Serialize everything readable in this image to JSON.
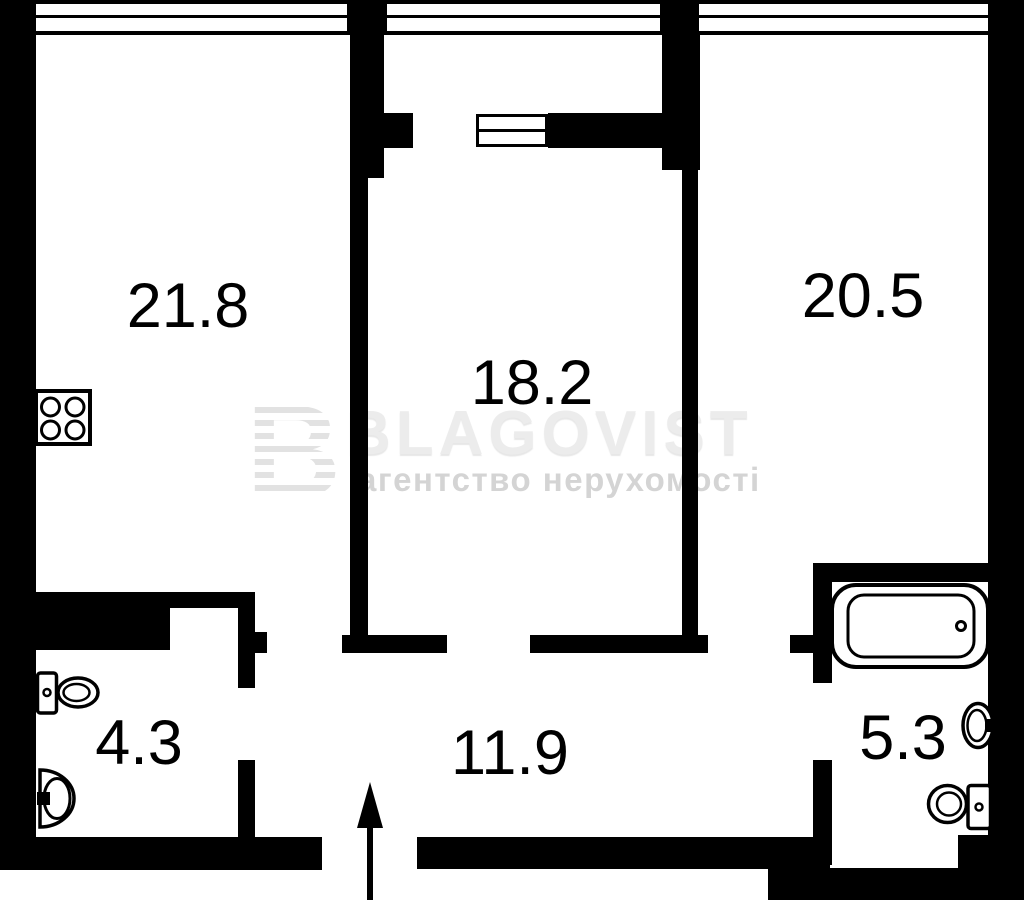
{
  "watermark": {
    "logo_letter": "B",
    "brand": "BLAGOVIST",
    "tagline": "агентство нерухомості"
  },
  "rooms": [
    {
      "name": "room-top-left",
      "area": "21.8"
    },
    {
      "name": "room-middle",
      "area": "18.2"
    },
    {
      "name": "room-top-right",
      "area": "20.5"
    },
    {
      "name": "bathroom-left",
      "area": "4.3"
    },
    {
      "name": "hallway",
      "area": "11.9"
    },
    {
      "name": "bathroom-right",
      "area": "5.3"
    }
  ],
  "fixtures": [
    "stove-icon",
    "toilet-icon",
    "sink-icon",
    "bathtub-icon",
    "entry-arrow-icon",
    "balcony-window-icon"
  ],
  "colors": {
    "wall": "#000000",
    "background": "#ffffff",
    "label": "#000000",
    "watermark_brand": "#ececec",
    "watermark_tagline": "#d4d4d4",
    "watermark_logo": "#e2e2e2"
  }
}
